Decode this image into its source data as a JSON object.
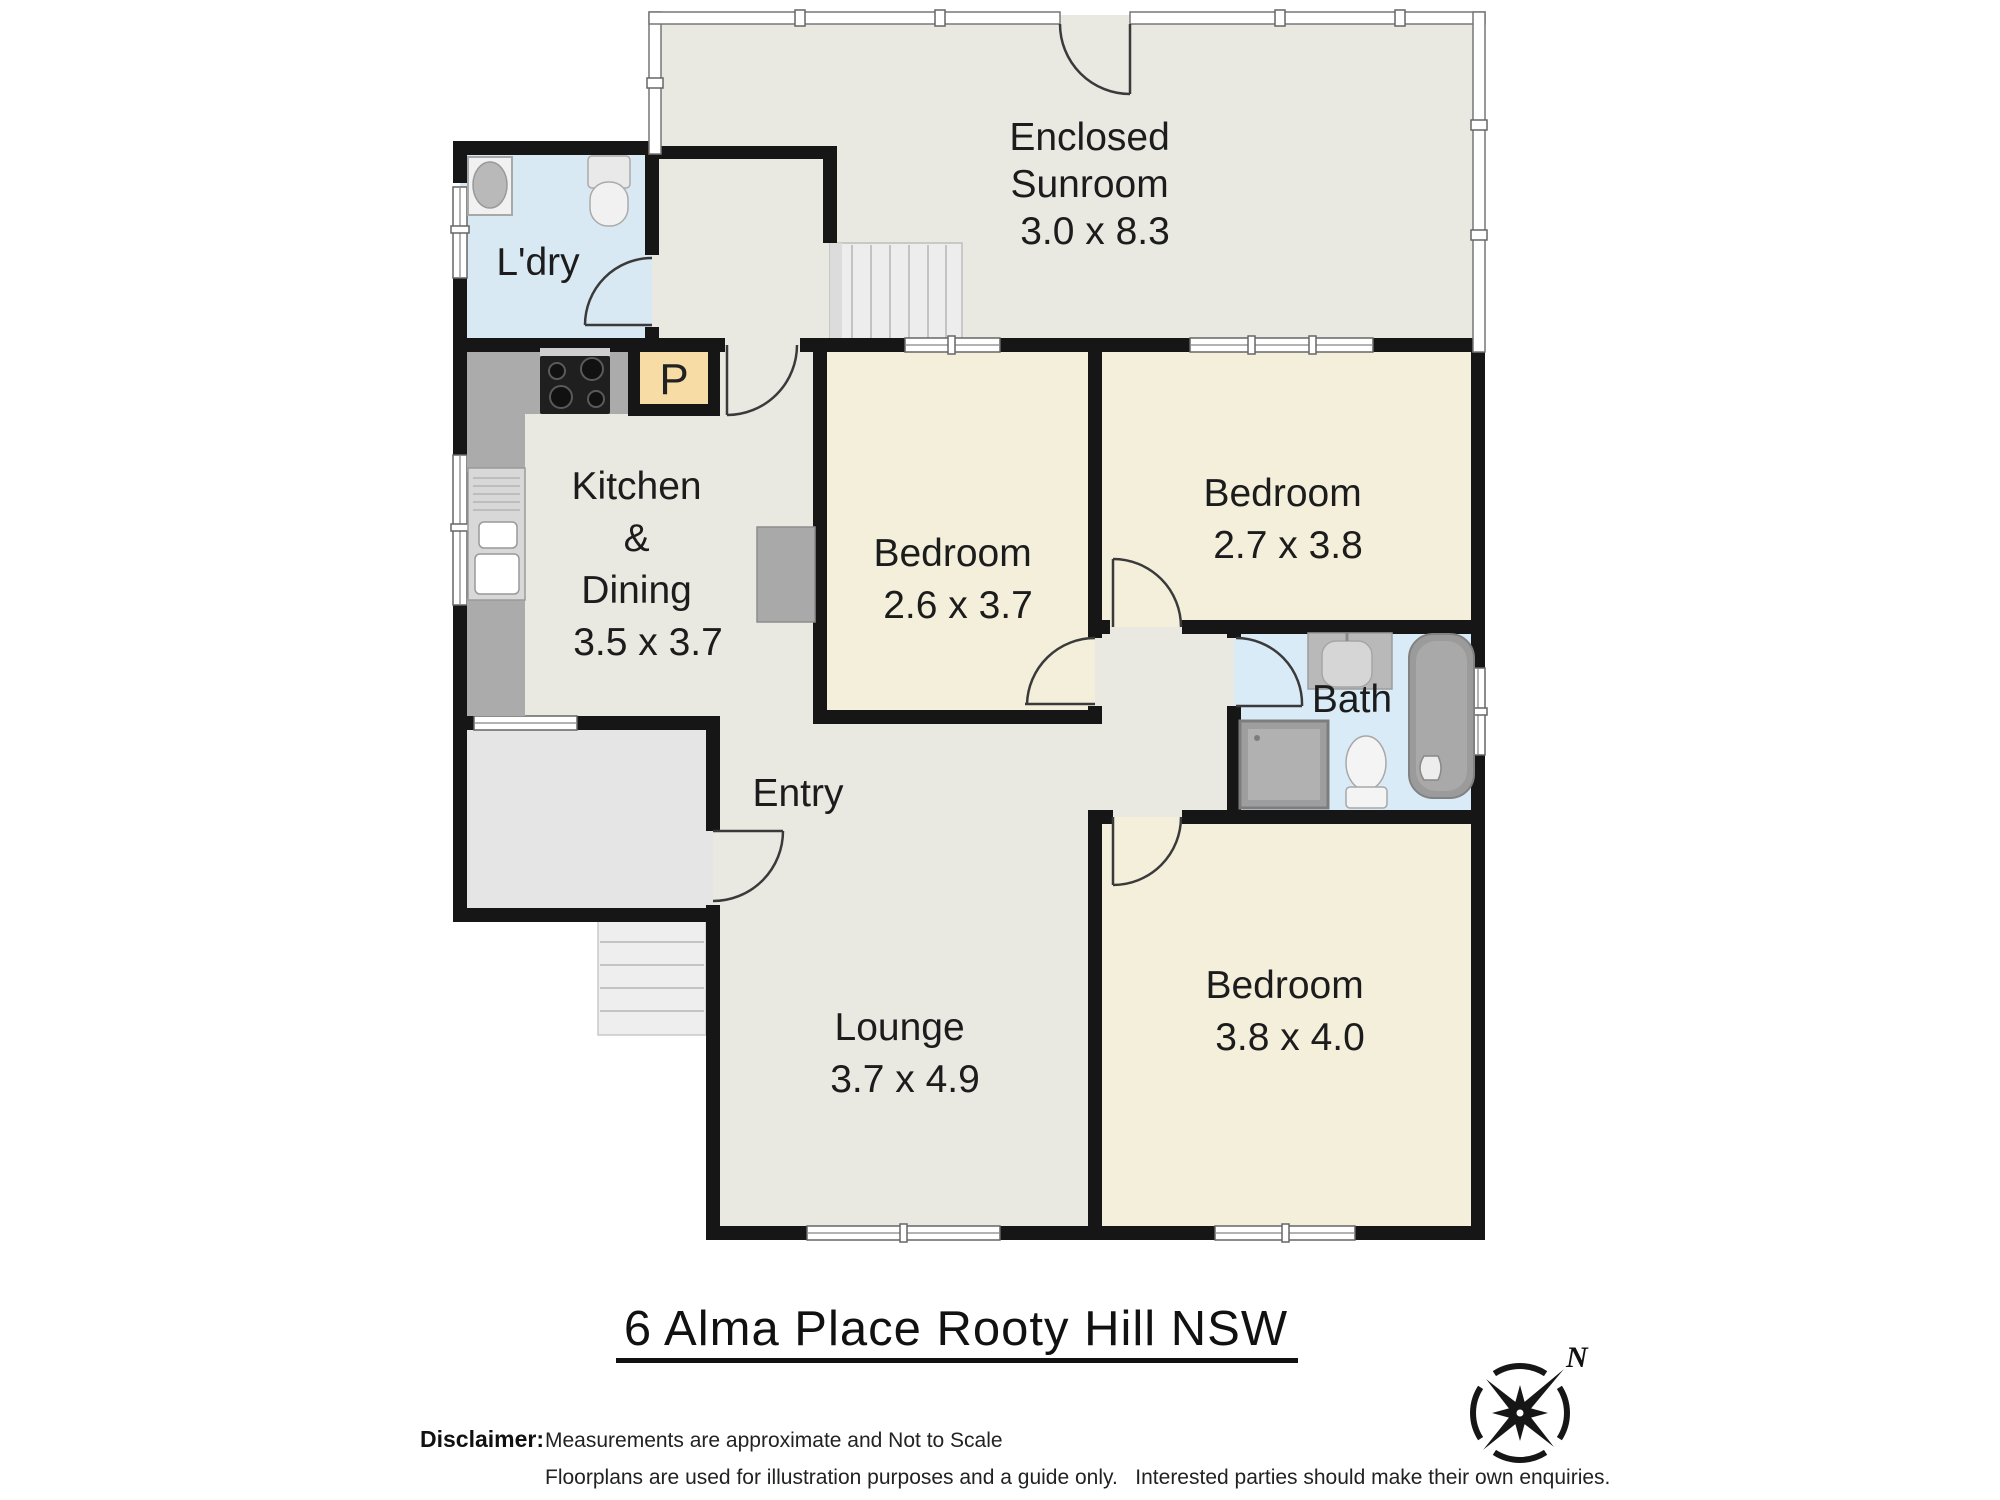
{
  "title": {
    "text": "6 Alma Place Rooty Hill  NSW"
  },
  "disclaimer": {
    "label": "Disclaimer:",
    "line1": "Measurements are approximate and Not to Scale",
    "line2": "Floorplans are used for illustration purposes and a guide only.   Interested parties should make their own enquiries."
  },
  "compass": {
    "north_label": "N"
  },
  "rooms": [
    {
      "id": "sunroom",
      "name": "Enclosed Sunroom",
      "dimensions": "3.0 x 8.3",
      "lines": [
        "Enclosed",
        "Sunroom",
        "3.0 x 8.3"
      ]
    },
    {
      "id": "laundry",
      "name": "L'dry",
      "dimensions": "",
      "lines": [
        "L'dry"
      ]
    },
    {
      "id": "kitchen",
      "name": "Kitchen & Dining",
      "dimensions": "3.5 x 3.7",
      "lines": [
        "Kitchen",
        "&",
        "Dining",
        "3.5 x 3.7"
      ]
    },
    {
      "id": "bedroom1",
      "name": "Bedroom",
      "dimensions": "2.6 x 3.7",
      "lines": [
        "Bedroom",
        "2.6 x 3.7"
      ]
    },
    {
      "id": "bedroom2",
      "name": "Bedroom",
      "dimensions": "2.7 x 3.8",
      "lines": [
        "Bedroom",
        "2.7 x 3.8"
      ]
    },
    {
      "id": "bath",
      "name": "Bath",
      "dimensions": "",
      "lines": [
        "Bath"
      ]
    },
    {
      "id": "entry",
      "name": "Entry",
      "dimensions": "",
      "lines": [
        "Entry"
      ]
    },
    {
      "id": "lounge",
      "name": "Lounge",
      "dimensions": "3.7 x 4.9",
      "lines": [
        "Lounge",
        "3.7 x 4.9"
      ]
    },
    {
      "id": "bedroom3",
      "name": "Bedroom",
      "dimensions": "3.8 x 4.0",
      "lines": [
        "Bedroom",
        "3.8 x 4.0"
      ]
    }
  ],
  "labels": {
    "pantry": "P"
  },
  "fixtures": [
    "washing-machine",
    "laundry-tub",
    "cooktop",
    "kitchen-sink",
    "refrigerator",
    "pantry-cupboard",
    "bath-vanity",
    "shower",
    "toilet",
    "bathtub",
    "internal-stairs",
    "front-steps"
  ],
  "colors": {
    "wall": "#161616",
    "living_floor": "#e9e9e2",
    "bedroom_floor": "#f3efdb",
    "wet_area_floor": "#d9e9f3",
    "bath_floor": "#d9ebf6",
    "porch_floor": "#e5e5e5",
    "pantry_fill": "#f7dca6",
    "counter_gray": "#ababab"
  }
}
